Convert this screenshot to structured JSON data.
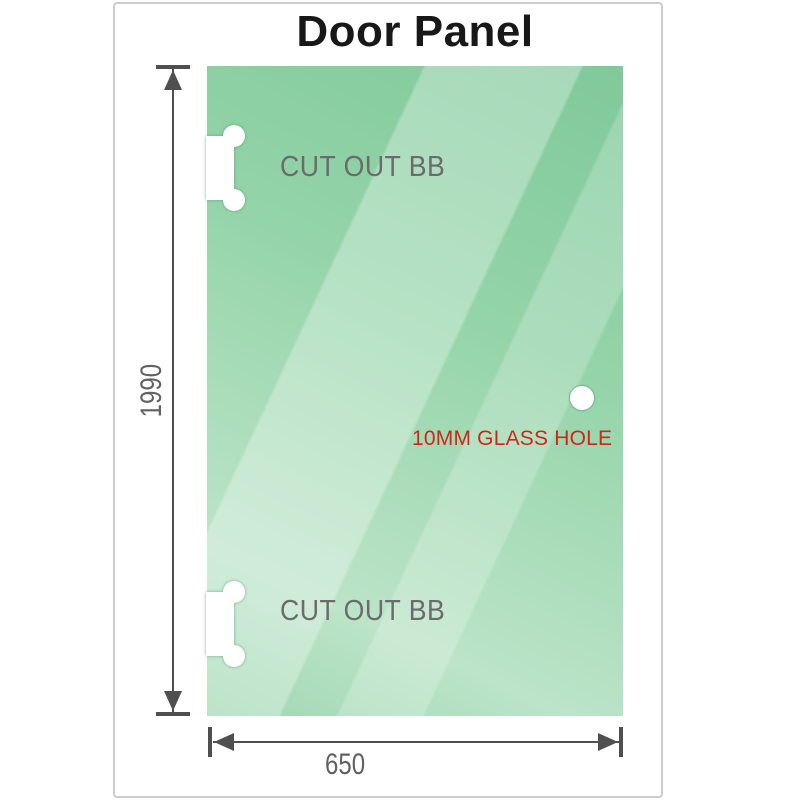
{
  "title": "Door Panel",
  "panel": {
    "cutouts": [
      {
        "label": "CUT OUT BB"
      },
      {
        "label": "CUT OUT BB"
      }
    ],
    "hole": {
      "label": "10MM GLASS HOLE"
    }
  },
  "dimensions": {
    "height": "1990",
    "width": "650"
  },
  "colors": {
    "glass_green": "#8fd2a6",
    "glass_highlight": "#c3e6cd",
    "dimension_color": "#4f4f4f",
    "label_gray": "#6b6b6b",
    "hole_label_red": "#d0261a",
    "frame_border": "#cccccc"
  }
}
